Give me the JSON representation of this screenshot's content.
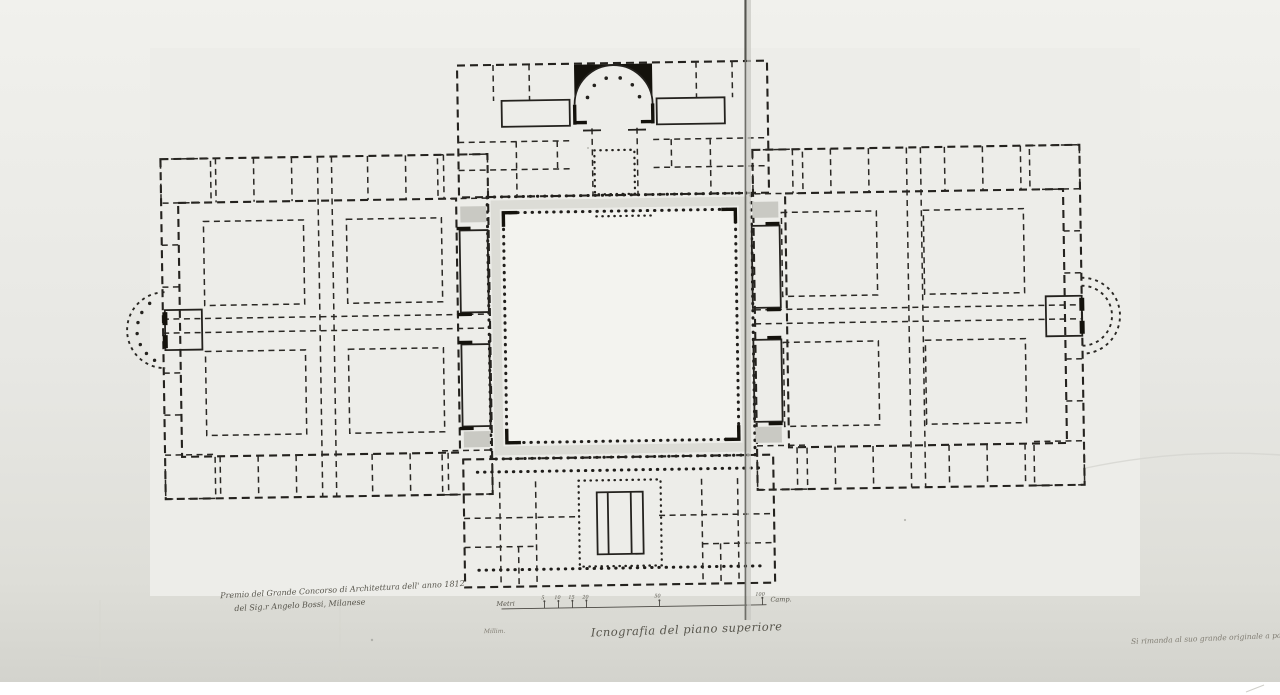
{
  "photo": {
    "description": "black-and-white photograph of an ink architectural drawing: symmetrical palace plan with central arcaded courtyard, apsed north vestibule, two four-court wings and lateral exedrae",
    "caption": {
      "title": "Icnografia del piano superiore"
    },
    "inscriptions": {
      "competition_line1": "Premio del Grande Concorso di Architettura dell' anno 1812",
      "competition_line2": "del Sig.r Angelo Bossi, Milanese",
      "margin_note": "Millim.",
      "archival_note": "Si rimanda al suo grande originale a parte"
    },
    "scale_bar": {
      "unit_label": "Metri",
      "tick_labels": [
        "5",
        "10",
        "15",
        "20"
      ],
      "mid_tick_label": "50",
      "end_tick_label": "100",
      "end_unit_label": "Camp."
    },
    "plan_parts": [
      "north vestibule block with semicircular apse",
      "central arcaded courtyard",
      "west wing with four courts",
      "east wing with four courts",
      "south block",
      "west exedra",
      "east exedra",
      "vertical fold crease"
    ],
    "colors": {
      "paper_light": "#f0f0ec",
      "paper_mid": "#e7e7e3",
      "paper_dark": "#d3d3cd",
      "ink": "#24221e",
      "stair_gray": "#c9c9c3",
      "fold_line": "#6e6e68",
      "background": "#ffffff"
    }
  }
}
